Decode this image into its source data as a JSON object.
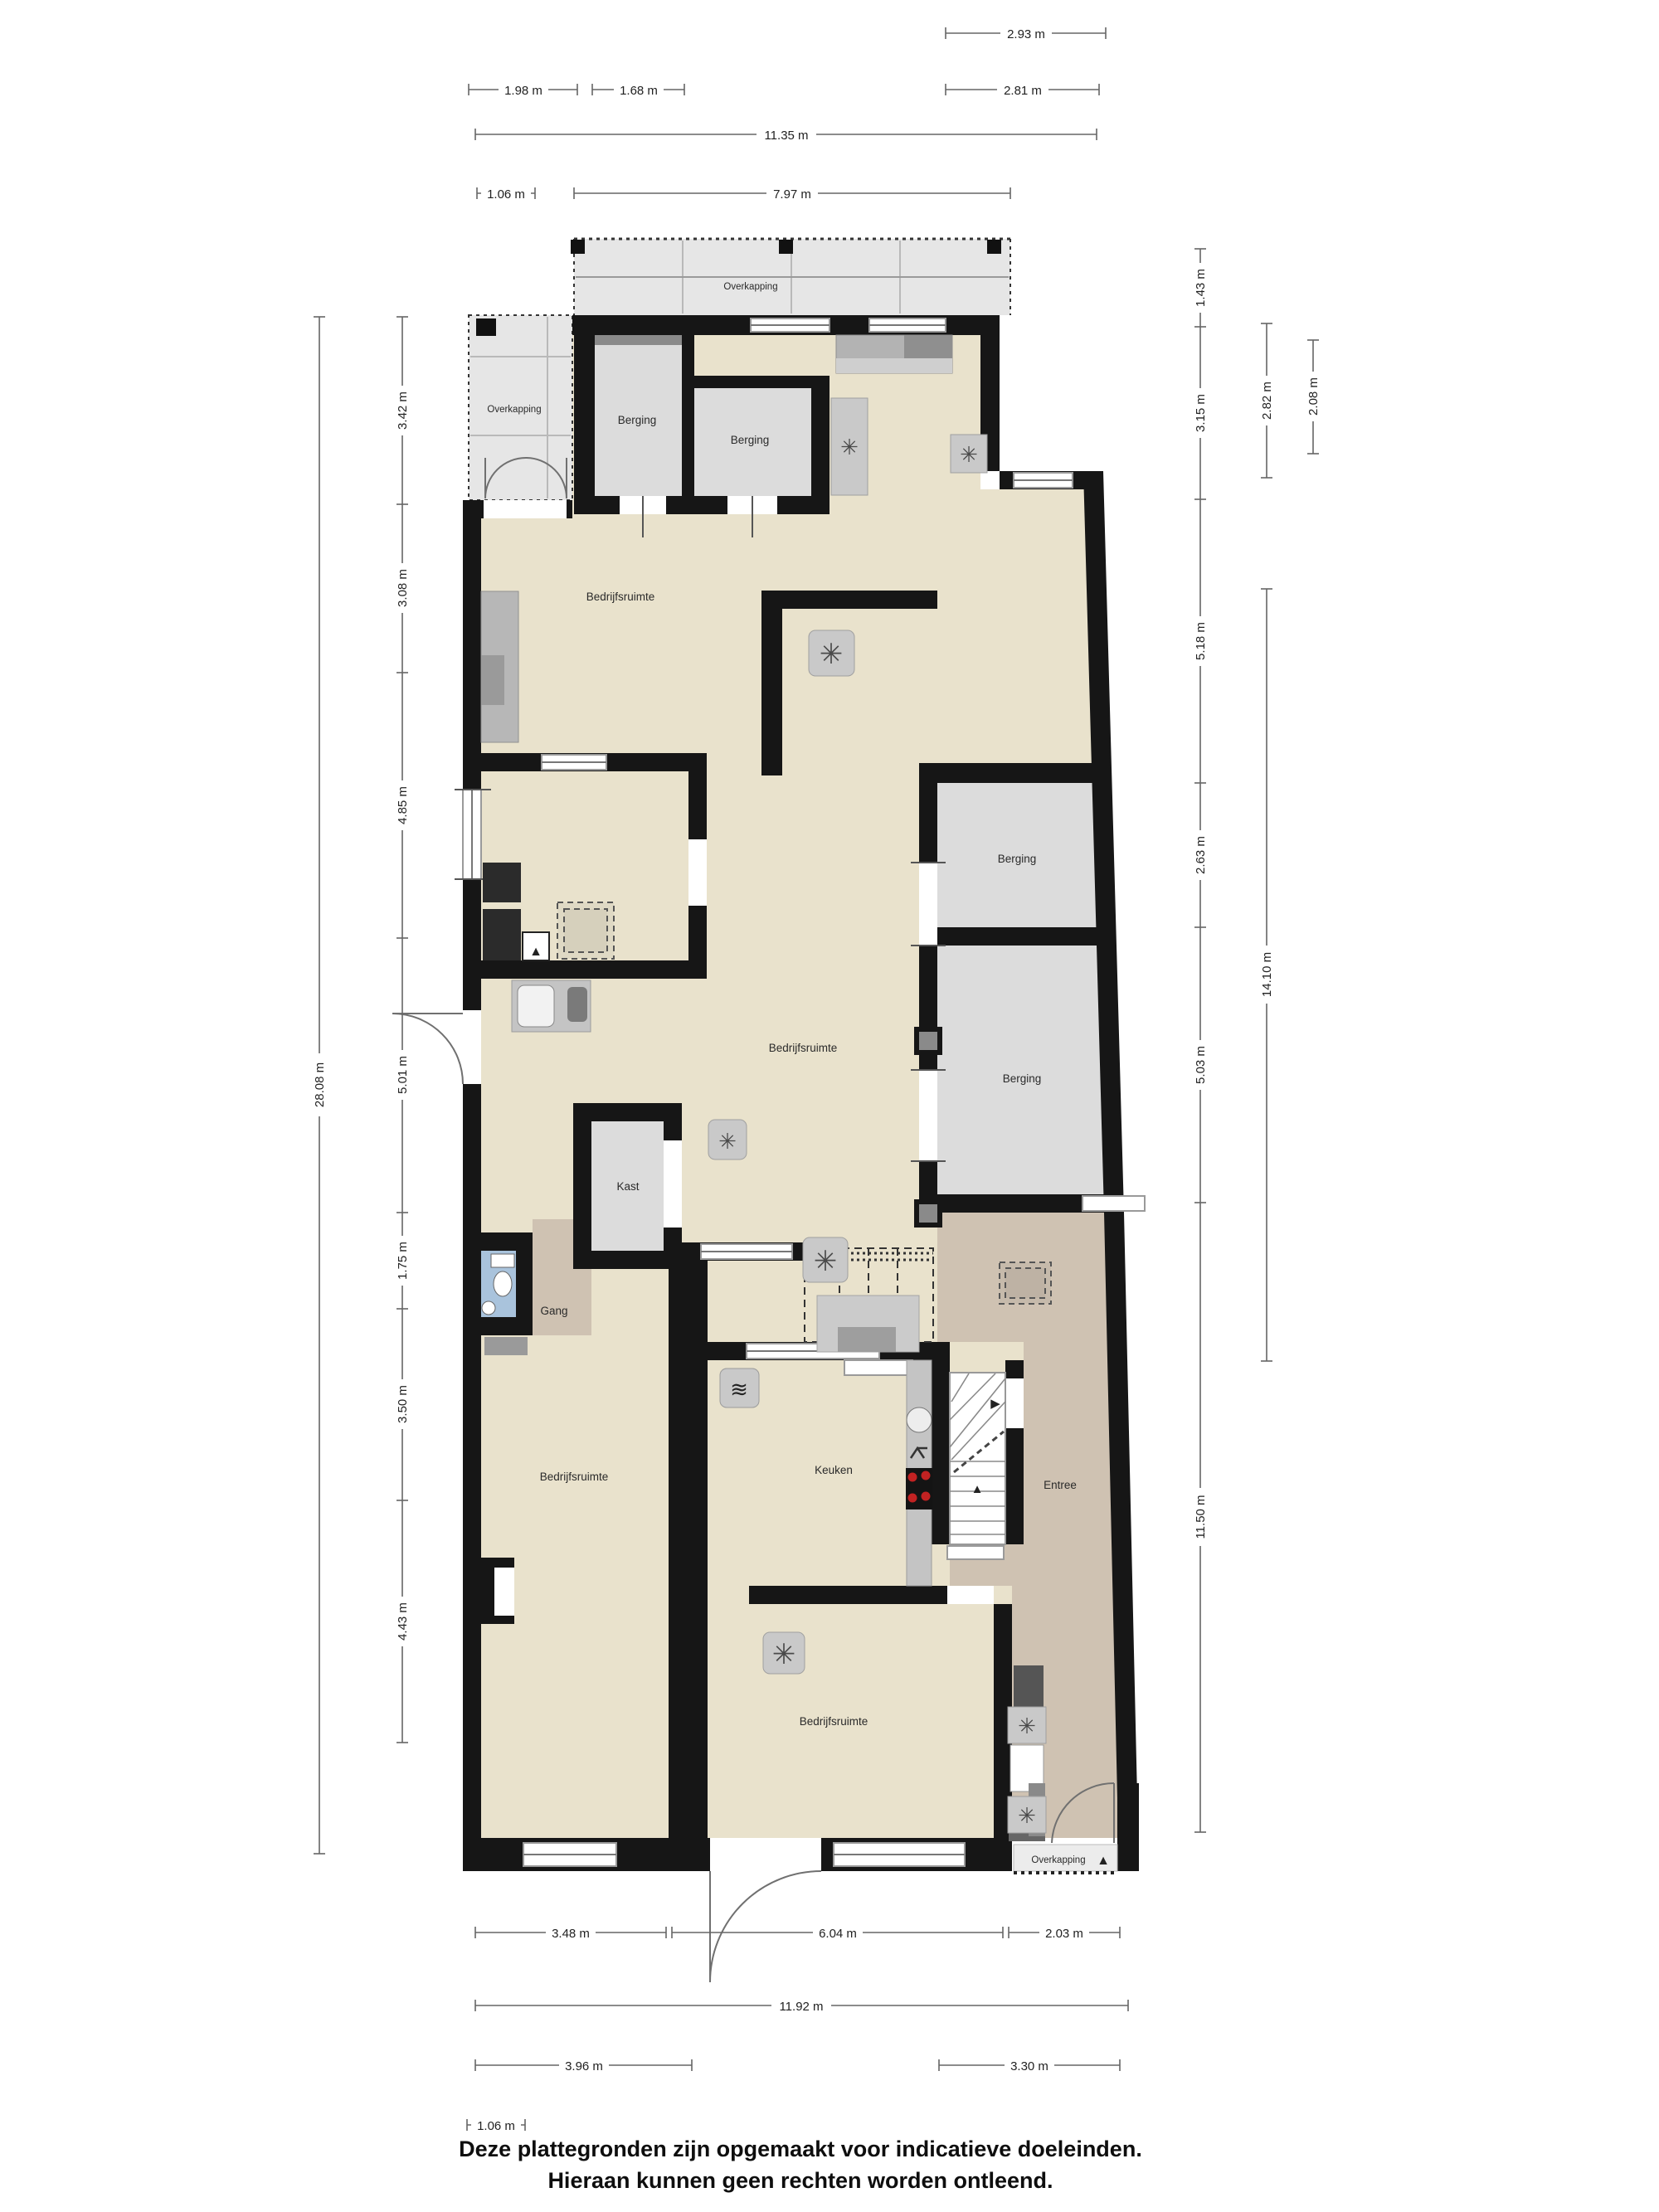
{
  "labels": [
    {
      "id": "overkapping-top",
      "text": "Overkapping"
    },
    {
      "id": "overkapping-left",
      "text": "Overkapping"
    },
    {
      "id": "berging-1",
      "text": "Berging"
    },
    {
      "id": "berging-2",
      "text": "Berging"
    },
    {
      "id": "bedrijfsruimte-1",
      "text": "Bedrijfsruimte"
    },
    {
      "id": "bedrijfsruimte-2",
      "text": "Bedrijfsruimte"
    },
    {
      "id": "berging-right-a",
      "text": "Berging"
    },
    {
      "id": "berging-right-b",
      "text": "Berging"
    },
    {
      "id": "kast",
      "text": "Kast"
    },
    {
      "id": "gang",
      "text": "Gang"
    },
    {
      "id": "bedrijfsruimte-3",
      "text": "Bedrijfsruimte"
    },
    {
      "id": "keuken",
      "text": "Keuken"
    },
    {
      "id": "entree",
      "text": "Entree"
    },
    {
      "id": "bedrijfsruimte-4",
      "text": "Bedrijfsruimte"
    },
    {
      "id": "overkapping-bottom",
      "text": "Overkapping"
    }
  ],
  "dimensions": {
    "top": [
      "2.93 m",
      "1.98 m",
      "1.68 m",
      "2.81 m",
      "11.35 m",
      "1.06 m",
      "7.97 m"
    ],
    "bottom": [
      "3.48 m",
      "6.04 m",
      "2.03 m",
      "11.92 m",
      "3.96 m",
      "3.30 m",
      "1.06 m"
    ],
    "left_outer": "28.08 m",
    "left": [
      "3.42 m",
      "3.08 m",
      "4.85 m",
      "5.01 m",
      "1.75 m",
      "3.50 m",
      "4.43 m"
    ],
    "right": [
      "1.43 m",
      "3.15 m",
      "5.18 m",
      "2.63 m",
      "5.03 m",
      "11.50 m"
    ],
    "right2": [
      "2.82 m",
      "14.10 m"
    ],
    "right3": [
      "2.08 m"
    ]
  },
  "icons": {
    "fan": "✳",
    "flame": "▲",
    "arrow_up": "▲",
    "arrow_right": "▶",
    "roof_arrow": "▲",
    "appliance": "≋"
  },
  "colors": {
    "floor": "#e9e2cc",
    "storage": "#dcdcdc",
    "canopy": "#e6e6e6",
    "entry": "#cfc2b2",
    "toilet": "#a9c3dc",
    "wall": "#161616",
    "burner": "#c22222"
  },
  "disclaimer": {
    "line1": "Deze plattegronden zijn opgemaakt voor indicatieve doeleinden.",
    "line2": "Hieraan kunnen geen rechten worden ontleend."
  }
}
